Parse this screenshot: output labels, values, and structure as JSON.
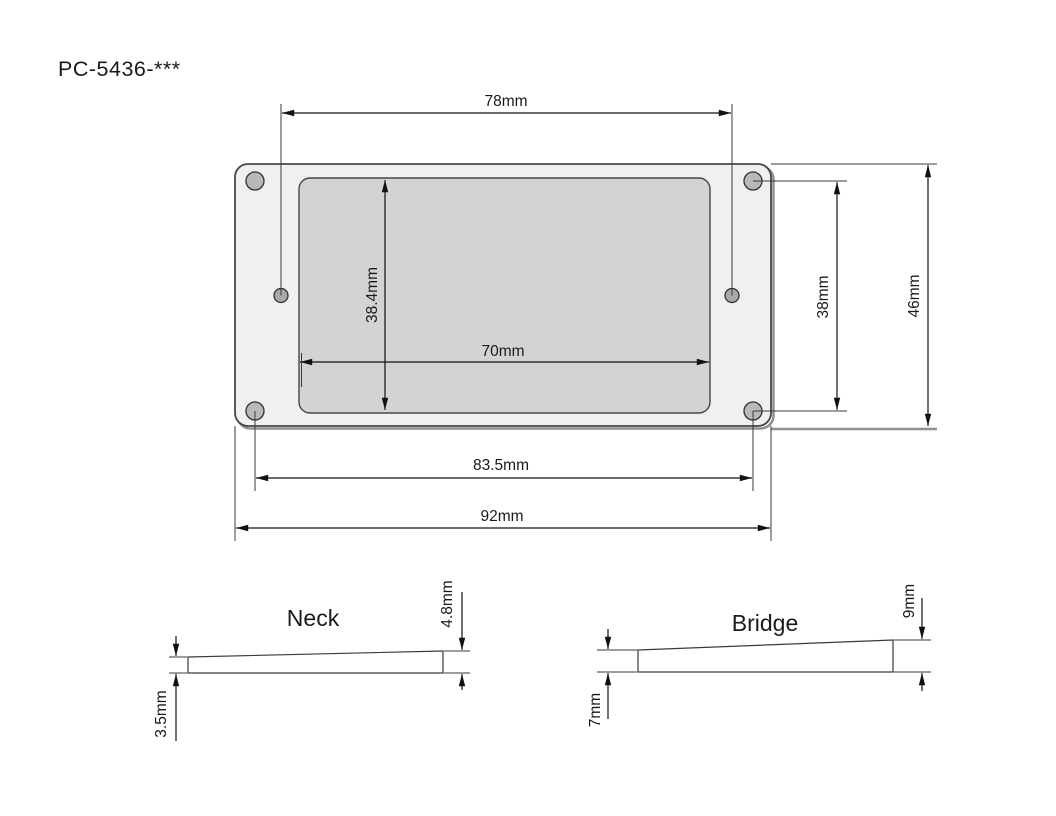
{
  "title": "PC-5436-***",
  "main_view": {
    "dim_top_hole_span": "78mm",
    "dim_cavity_height": "38.4mm",
    "dim_cavity_width": "70mm",
    "dim_side_hole_span": "38mm",
    "dim_overall_height": "46mm",
    "dim_bottom_hole_span": "83.5mm",
    "dim_overall_width": "92mm"
  },
  "neck_profile": {
    "label": "Neck",
    "thickness_right": "4.8mm",
    "thickness_left": "3.5mm"
  },
  "bridge_profile": {
    "label": "Bridge",
    "thickness_right": "9mm",
    "thickness_left": "7mm"
  },
  "colors": {
    "plate_fill": "#f0f0f0",
    "cavity_fill": "#d3d3d3",
    "corner_hole_fill": "#b9b9b9",
    "side_hole_fill": "#a9a9a9",
    "line": "#1a1a1a"
  }
}
